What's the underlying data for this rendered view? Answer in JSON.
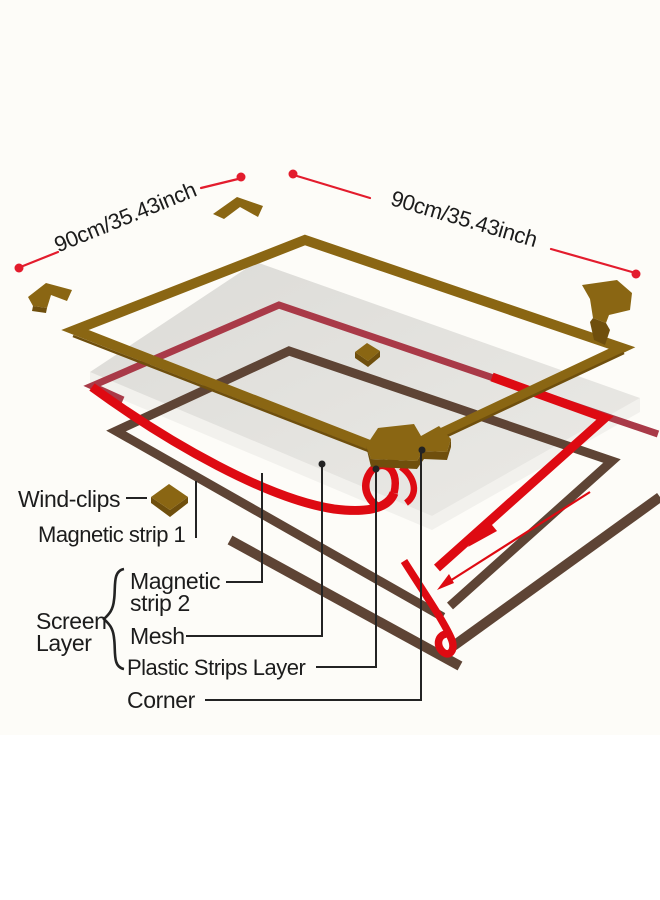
{
  "diagram": {
    "dimensions": {
      "left": "90cm/35.43inch",
      "right": "90cm/35.43inch"
    },
    "labels": {
      "wind_clips": "Wind-clips",
      "magnetic_strip_1": "Magnetic strip 1",
      "magnetic_strip_2": [
        "Magnetic",
        "strip 2"
      ],
      "screen_layer": [
        "Screen",
        "Layer"
      ],
      "mesh": "Mesh",
      "plastic_strips_layer": "Plastic Strips Layer",
      "corner": "Corner"
    },
    "colors": {
      "frame_brown": "#8a6613",
      "frame_brown_dark": "#6f4f0d",
      "mesh_gray": "#dcdbd7",
      "mesh_gray_light": "#ebeae6",
      "mesh_side": "#f2f1ed",
      "magnet_maroon": "#a93a48",
      "magnet_red": "#de0a12",
      "plastic_walnut": "#5e4435",
      "callout_dark": "#232323",
      "dimension_red": "#e31c2d",
      "text_dark": "#1c1c1c",
      "background": "#fdfcf8"
    }
  }
}
